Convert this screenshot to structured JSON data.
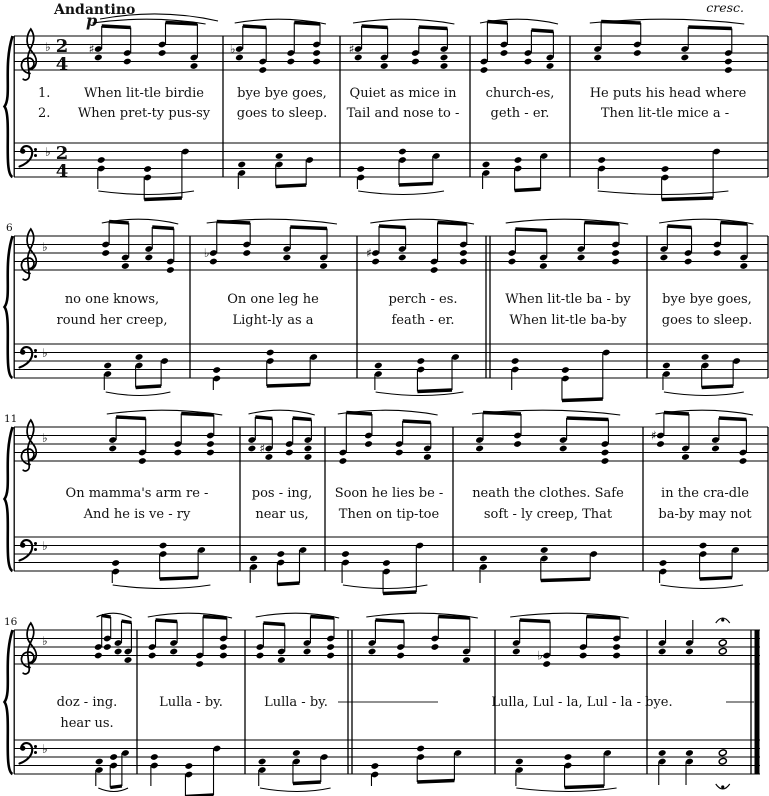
{
  "score": {
    "tempo": "Andantino",
    "dynamic": "p",
    "crescendo": "cresc.",
    "time_signature": {
      "numerator": "2",
      "denominator": "4"
    },
    "glyphs": {
      "flat": "♭",
      "sharp": "♯"
    },
    "verse_labels": [
      "1.",
      "2."
    ],
    "systems": [
      {
        "measure_number": "",
        "verse1": [
          "When lit-tle birdie",
          "bye bye goes,",
          "Quiet as mice in",
          "church-es,",
          "He puts his head where"
        ],
        "verse2": [
          "When pret-ty pus-sy",
          "goes to sleep.",
          "Tail and nose to -",
          "geth - er.",
          "Then lit-tle mice a -"
        ]
      },
      {
        "measure_number": "6",
        "verse1": [
          "no one knows,",
          "On one leg he",
          "perch - es.",
          "When lit-tle ba - by",
          "bye bye goes,"
        ],
        "verse2": [
          "round her creep,",
          "Light-ly as a",
          "feath - er.",
          "When lit-tle ba-by",
          "goes to sleep."
        ]
      },
      {
        "measure_number": "11",
        "verse1": [
          "On mamma's arm re -",
          "pos - ing,",
          "Soon he lies be -",
          "neath the clothes. Safe",
          "in the cra-dle"
        ],
        "verse2": [
          "And he is ve - ry",
          "near us,",
          "Then on tip-toe",
          "soft - ly creep, That",
          "ba-by may not"
        ]
      },
      {
        "measure_number": "16",
        "verse1": [
          "doz - ing.",
          "Lulla - by.",
          "Lulla - by.",
          "Lulla, Lul - la, Lul - la - bye."
        ],
        "verse2": [
          "hear us."
        ]
      }
    ]
  }
}
